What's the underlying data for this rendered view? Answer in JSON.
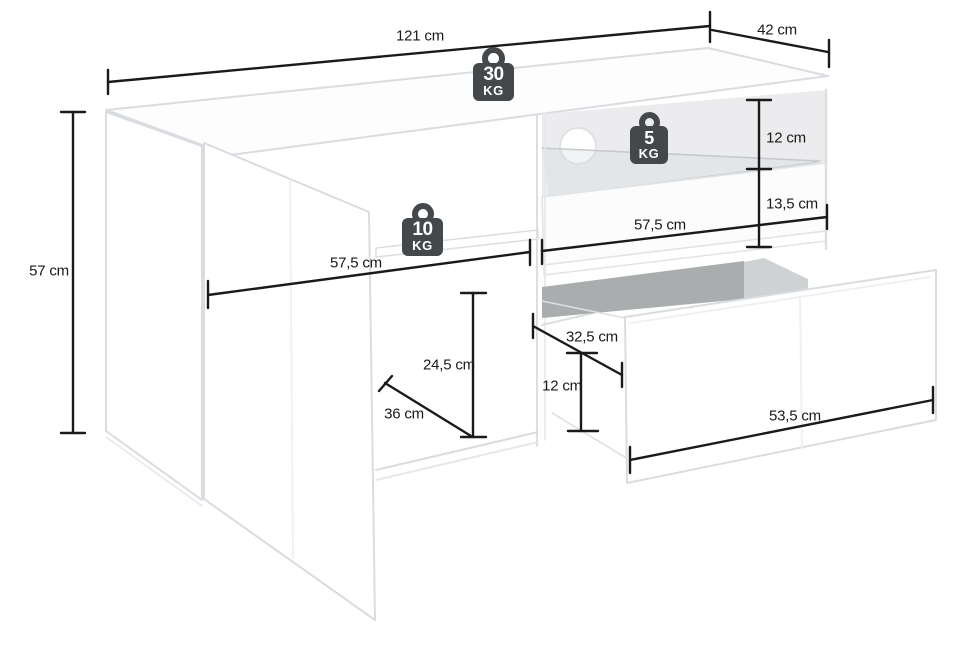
{
  "diagram": {
    "title": "tv-lowboard-dimension-diagram",
    "unit": "cm",
    "dimensions": [
      {
        "id": "width-overall",
        "label": "121 cm"
      },
      {
        "id": "depth-overall",
        "label": "42 cm"
      },
      {
        "id": "height-overall",
        "label": "57 cm"
      },
      {
        "id": "glass-shelf-clearance",
        "label": "12 cm"
      },
      {
        "id": "below-glass-clearance",
        "label": "13,5 cm"
      },
      {
        "id": "right-compartment-width",
        "label": "57,5 cm"
      },
      {
        "id": "left-compartment-width",
        "label": "57,5 cm"
      },
      {
        "id": "left-compartment-height",
        "label": "24,5 cm"
      },
      {
        "id": "left-compartment-depth",
        "label": "36 cm"
      },
      {
        "id": "drawer-depth",
        "label": "32,5 cm"
      },
      {
        "id": "drawer-height",
        "label": "12 cm"
      },
      {
        "id": "drawer-width",
        "label": "53,5 cm"
      }
    ],
    "weight_capacities": [
      {
        "id": "top-surface",
        "value": "30",
        "unit": "KG"
      },
      {
        "id": "glass-shelf",
        "value": "5",
        "unit": "KG"
      },
      {
        "id": "left-shelf",
        "value": "10",
        "unit": "KG"
      }
    ],
    "colors": {
      "dimension_line": "#1a1a1a",
      "badge": "#45484b",
      "edge": "#d9dce0",
      "back_panel": "#ececee",
      "cavity_dark": "#a9adad",
      "cavity_light": "#ced2d3"
    }
  }
}
